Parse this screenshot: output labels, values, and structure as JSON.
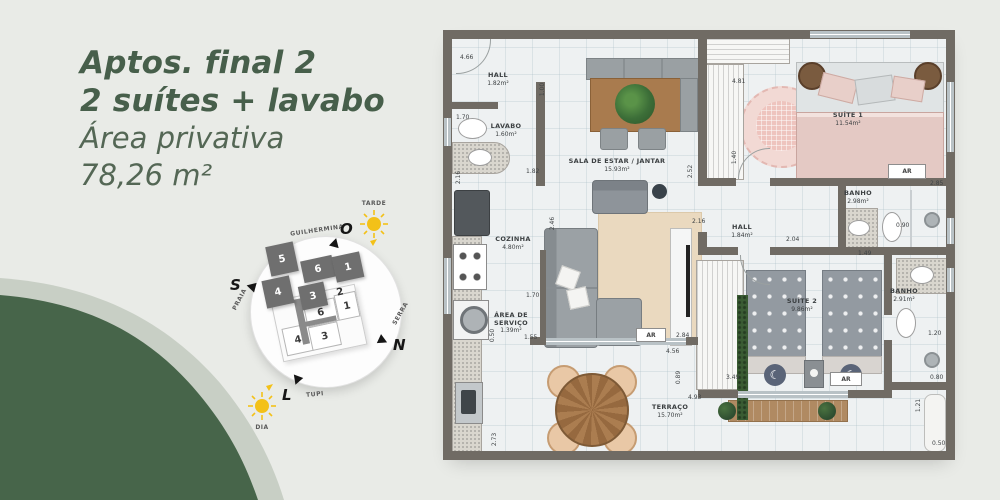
{
  "header": {
    "line1": "Aptos. final 2",
    "line2": "2 suítes + lavabo",
    "line3": "Área privativa",
    "line4": "78,26 m²"
  },
  "colors": {
    "accent_green": "#475f4b",
    "wave_dark": "#47654a",
    "wave_light": "#c8cfc5",
    "sun_yellow": "#f3c118",
    "wall_gray": "#706b64"
  },
  "compass": {
    "streets": {
      "top": "GUILHERMINA",
      "left": "PRAIA",
      "right": "SERRA",
      "bottom": "TUPI"
    },
    "cardinal": {
      "west": "O",
      "south": "S",
      "north": "N",
      "east": "L"
    },
    "suns": {
      "afternoon": "TARDE",
      "day": "DIA"
    },
    "units_shadow": [
      "5",
      "6",
      "1",
      "4",
      "3",
      "2"
    ],
    "units_plan": [
      "6",
      "1",
      "4",
      "3"
    ]
  },
  "floorplan": {
    "rooms": [
      {
        "name": "HALL",
        "area": "1.82m²"
      },
      {
        "name": "LAVABO",
        "area": "1.60m²"
      },
      {
        "name": "COZINHA",
        "area": "4.80m²"
      },
      {
        "name": "ÁREA DE SERVIÇO",
        "area": "1.39m²"
      },
      {
        "name": "SALA DE ESTAR / JANTAR",
        "area": "15.93m²"
      },
      {
        "name": "TERRAÇO",
        "area": "15.70m²"
      },
      {
        "name": "SUÍTE 1",
        "area": "11.54m²"
      },
      {
        "name": "HALL",
        "area": "1.84m²"
      },
      {
        "name": "BANHO",
        "area": "2.98m²"
      },
      {
        "name": "SUÍTE 2",
        "area": "9.86m²"
      },
      {
        "name": "BANHO",
        "area": "2.91m²"
      }
    ],
    "ac_label": "AR",
    "dims": [
      "4.66",
      "1.70",
      "1.00",
      "1.82",
      "2.16",
      "2.52",
      "4.81",
      "1.40",
      "2.16",
      "2.04",
      "2.85",
      "0.90",
      "1.49",
      "1.20",
      "0.80",
      "1.21",
      "0.50",
      "3.49",
      "4.93",
      "0.89",
      "4.56",
      "2.84",
      "2.46",
      "1.70",
      "1.55",
      "0.50",
      "2.73"
    ]
  }
}
